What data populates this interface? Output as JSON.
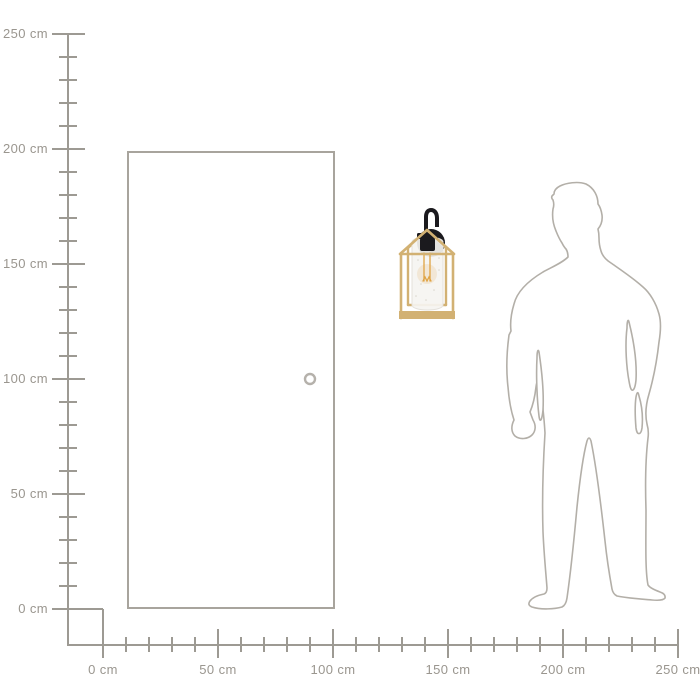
{
  "rulers": {
    "unit": "cm",
    "line_color": "#9d9a93",
    "label_color": "#9a968f",
    "vertical_labels": [
      "250 cm",
      "200 cm",
      "150 cm",
      "100 cm",
      "50 cm",
      "0 cm"
    ],
    "horizontal_labels": [
      "0 cm",
      "50 cm",
      "100 cm",
      "150 cm",
      "200 cm",
      "250 cm"
    ]
  },
  "objects": {
    "door": {
      "name": "door-outline-with-knob",
      "stroke": "#a8a49d",
      "knob_stroke": "#b5b1ab"
    },
    "person": {
      "name": "human-silhouette",
      "stroke": "#b3afa8"
    },
    "lamp": {
      "name": "black-and-gold-wall-lantern-light",
      "frame_gold": "#d2b173",
      "mount_black": "#1b1a1e",
      "glass": "#f5f4f1",
      "glass_edge": "#e4e1db",
      "filament_amber": "#dfa343"
    }
  }
}
